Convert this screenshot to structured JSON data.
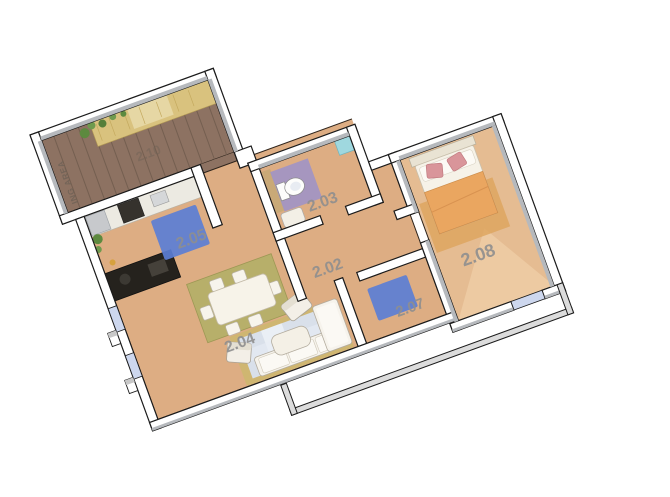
{
  "scene": {
    "type": "3d-floor-plan",
    "background": "#ffffff",
    "rotation_deg": -20
  },
  "rooms": {
    "hallway": {
      "number": "2.02"
    },
    "bathroom": {
      "number": "2.03"
    },
    "living_dining": {
      "number": "2.04"
    },
    "kitchen": {
      "number": "2.05"
    },
    "room_2_07": {
      "number": "2.07"
    },
    "bedroom": {
      "number": "2.08"
    },
    "terrace_deck": {
      "number": "2.10",
      "area_label": "ING AREA"
    }
  },
  "colors": {
    "floor_tan": "#ddad83",
    "bedroom_floor": "#e5bc92",
    "deck_brown": "#8d7262",
    "straw_mat": "#d9c27e",
    "straw_light": "#e6d7a4",
    "rug_blue": "#5b7ed5",
    "rug_olive": "#b5b069",
    "rug_living_border": "#c9ba6b",
    "rug_living_inner": "#d9e3f0",
    "bath_mat_purple": "#a093c5",
    "shower_cyan": "#9fd8df",
    "blanket_orange": "#eaa660",
    "pillow_pink": "#d9959a",
    "window_blue": "#cdd7ee",
    "wall_white": "#ffffff",
    "wall_face_gray": "#b6b9bd",
    "parapet_gray": "#dcdcdc",
    "label_gray": "#8f8f8f",
    "deck_label_gray": "#6d6156"
  }
}
